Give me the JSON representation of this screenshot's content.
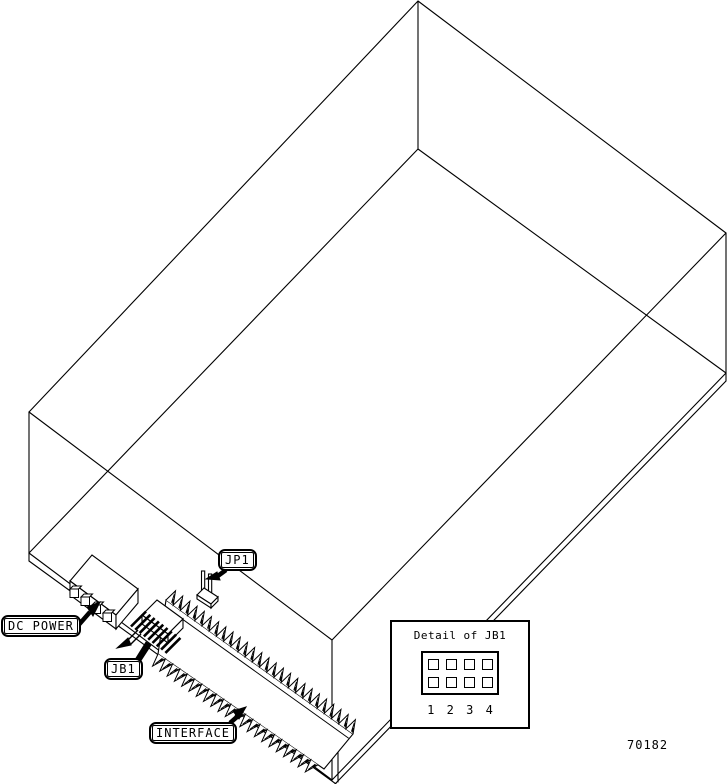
{
  "figure": {
    "number": "70182"
  },
  "callouts": {
    "dc_power": "DC POWER",
    "jb1": "JB1",
    "jp1": "JP1",
    "interface": "INTERFACE"
  },
  "detail_box": {
    "title": "Detail of JB1",
    "pin_labels": [
      "1",
      "2",
      "3",
      "4"
    ]
  }
}
